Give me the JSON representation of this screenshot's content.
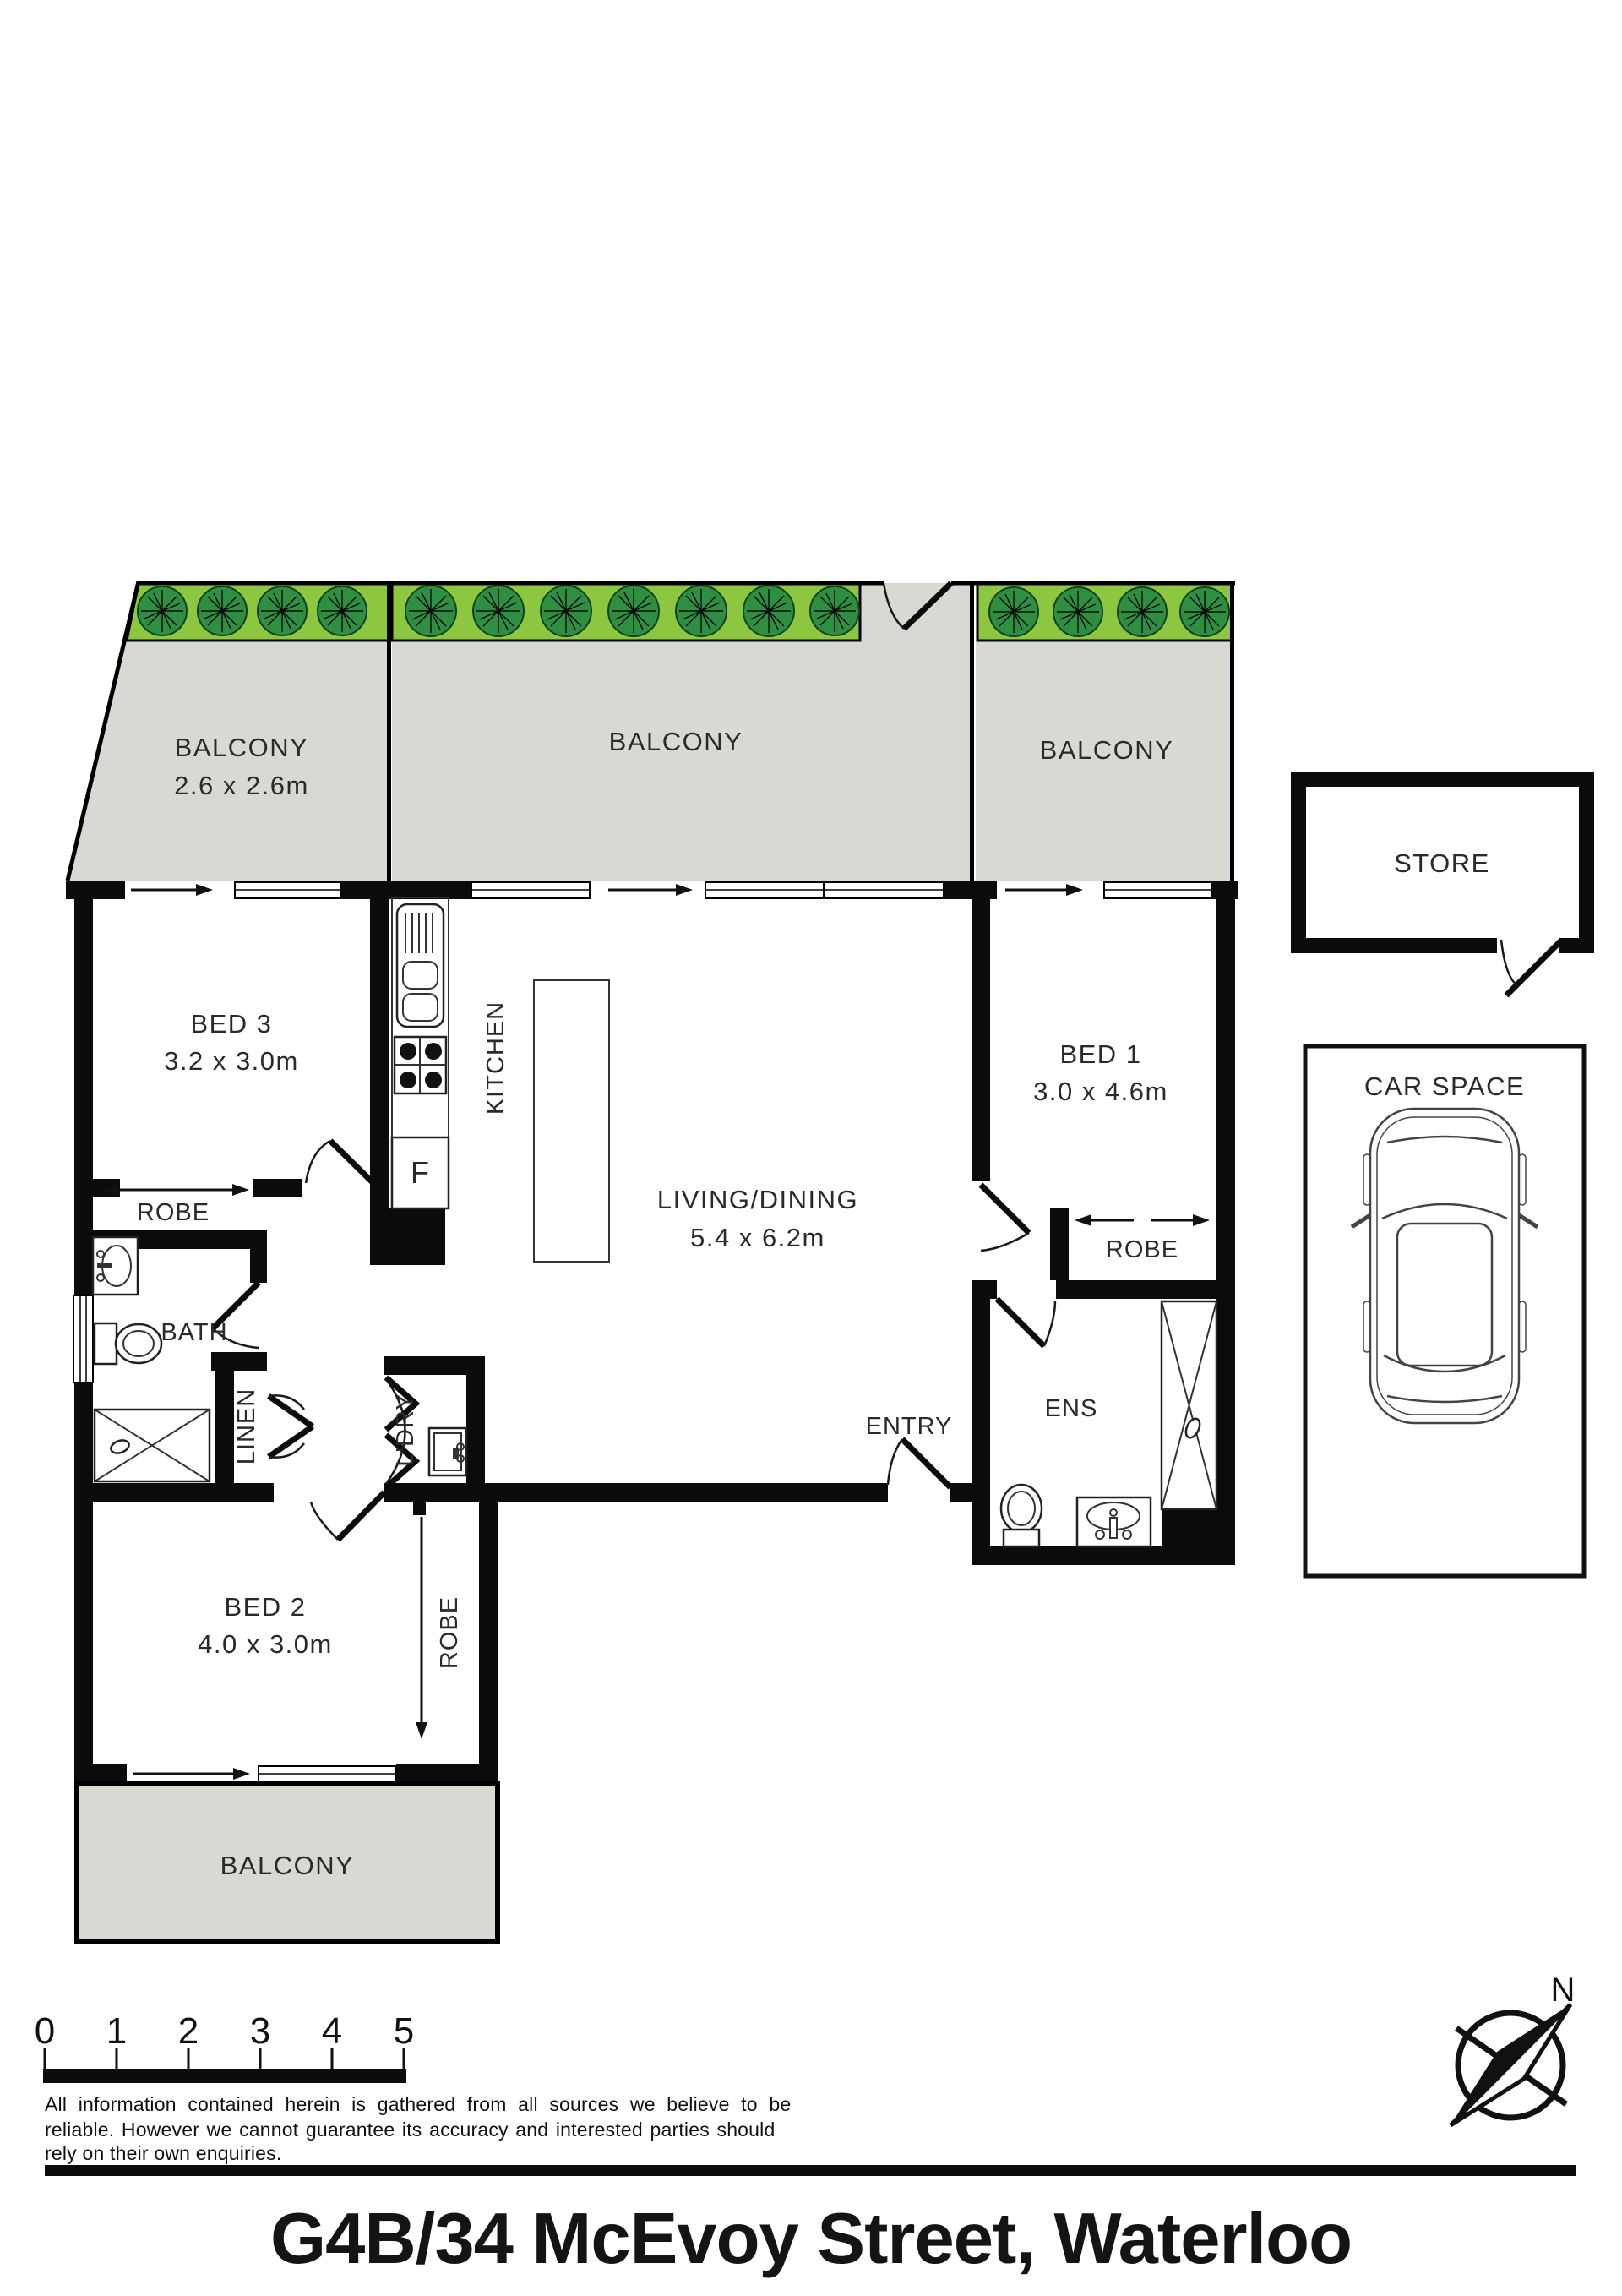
{
  "colors": {
    "hedge_green": "#8dc63f",
    "tree_green": "#2e8f43",
    "balcony_grey": "#d9d8d2",
    "wall_black": "#0b0b0b"
  },
  "title": "G4B/34 McEvoy Street, Waterloo",
  "compass": {
    "north": "N"
  },
  "scale_bar": {
    "labels": [
      "0",
      "1",
      "2",
      "3",
      "4",
      "5"
    ]
  },
  "disclaimer": {
    "line1": "All information contained herein is gathered from all sources we believe to be",
    "line2": "reliable. However we cannot guarantee its accuracy and interested parties should",
    "line3": "rely on their own enquiries."
  },
  "rooms": {
    "balcony": "BALCONY",
    "balcony_left_dims": "2.6 x 2.6m",
    "bed3": {
      "label": "BED 3",
      "dims": "3.2 x 3.0m"
    },
    "bed2": {
      "label": "BED 2",
      "dims": "4.0 x 3.0m"
    },
    "bed1": {
      "label": "BED 1",
      "dims": "3.0 x 4.6m"
    },
    "living": {
      "label": "LIVING/DINING",
      "dims": "5.4 x 6.2m"
    },
    "kitchen": "KITCHEN",
    "bath": "BATH",
    "ens": "ENS",
    "entry": "ENTRY",
    "linen": "LINEN",
    "laundry": "L'DRY",
    "robe": "ROBE",
    "store": "STORE",
    "car_space": "CAR SPACE",
    "fridge": "F"
  }
}
